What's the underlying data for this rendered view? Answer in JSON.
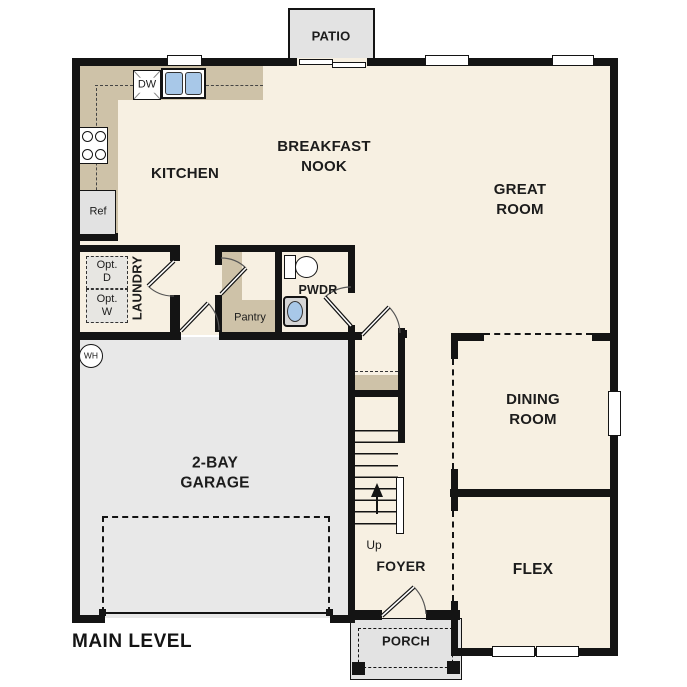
{
  "title": "MAIN LEVEL",
  "colors": {
    "floor": "#f7f0e2",
    "garage_floor": "#e8e8e8",
    "outdoor_gray": "#e3e3e3",
    "counter_tan": "#cec2a8",
    "wall": "#141414",
    "fixture_blue": "#a8c8e8"
  },
  "rooms": {
    "patio": "PATIO",
    "kitchen": "KITCHEN",
    "nook": "BREAKFAST\nNOOK",
    "great": "GREAT\nROOM",
    "dining": "DINING\nROOM",
    "flex": "FLEX",
    "foyer": "FOYER",
    "garage": "2-BAY\nGARAGE",
    "laundry": "LAUNDRY",
    "pwdr": "PWDR",
    "pantry": "Pantry",
    "porch": "PORCH"
  },
  "fixtures": {
    "dishwasher": "DW",
    "refrigerator": "Ref",
    "optional_dryer": "Opt.\nD",
    "optional_washer": "Opt.\nW",
    "water_heater": "WH",
    "stairs_up": "Up"
  }
}
